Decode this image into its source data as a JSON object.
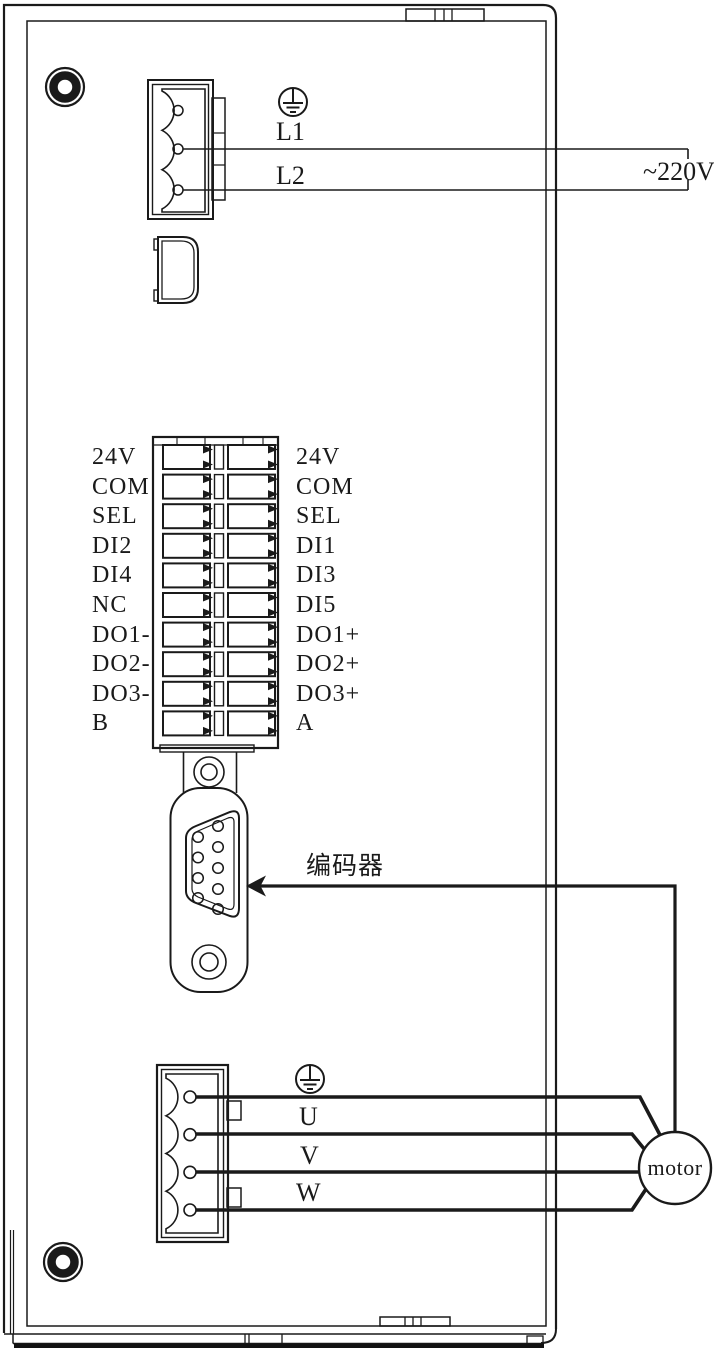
{
  "power_input": {
    "ground_icon": "protective-earth",
    "line1": "L1",
    "line2": "L2",
    "voltage": "~220V"
  },
  "io_terminal": {
    "left_labels": [
      "24V",
      "COM",
      "SEL",
      "DI2",
      "DI4",
      "NC",
      "DO1-",
      "DO2-",
      "DO3-",
      "B"
    ],
    "right_labels": [
      "24V",
      "COM",
      "SEL",
      "DI1",
      "DI3",
      "DI5",
      "DO1+",
      "DO2+",
      "DO3+",
      "A"
    ]
  },
  "encoder": {
    "label": "编码器"
  },
  "motor_output": {
    "ground_icon": "protective-earth",
    "phase_u": "U",
    "phase_v": "V",
    "phase_w": "W",
    "motor_label": "motor"
  },
  "colors": {
    "line": "#1a1a1a",
    "background": "#ffffff"
  }
}
